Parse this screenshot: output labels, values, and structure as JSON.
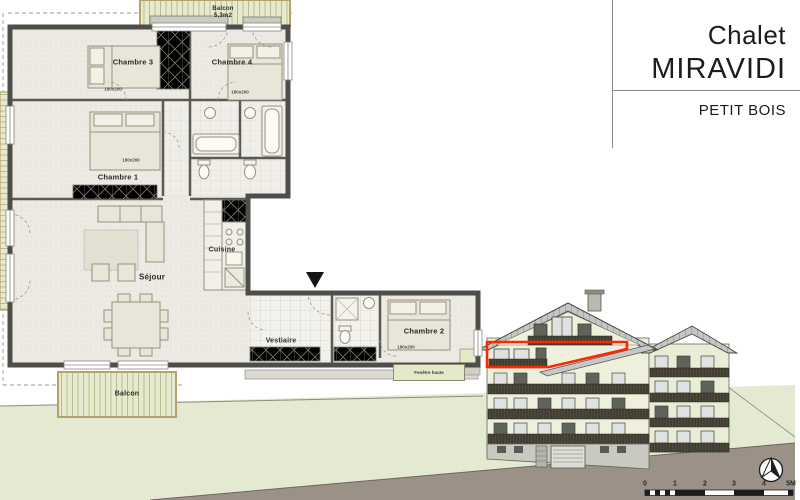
{
  "title_block": {
    "project": "Chalet",
    "name": "MIRAVIDI",
    "unit": "PETIT BOIS"
  },
  "plan": {
    "balcony_top": {
      "label": "Balcon",
      "area": "5,3m2"
    },
    "balcony_bottom": {
      "label": "Balcon"
    },
    "rooms": {
      "chambre1": {
        "label": "Chambre 1",
        "size": "180x200"
      },
      "chambre2": {
        "label": "Chambre 2",
        "size": "180x200"
      },
      "chambre3": {
        "label": "Chambre 3",
        "size": "180x200"
      },
      "chambre4": {
        "label": "Chambre 4",
        "size": "180x200"
      },
      "sejour": {
        "label": "Séjour"
      },
      "cuisine": {
        "label": "Cuisine"
      },
      "vestiaire": {
        "label": "Vestiaire"
      }
    },
    "window_note": "Fenêtre haute"
  },
  "elevation": {
    "highlight_color": "#ff2600"
  },
  "scale_bar": {
    "ticks": [
      "0",
      "1",
      "2",
      "3",
      "4",
      "5M"
    ]
  },
  "colors": {
    "highlight_red": "#ff2600",
    "site_green": "#e4ead1",
    "road_gray": "#9b9187",
    "roof_gray": "#c6c6c6",
    "facade": "#eef0dc",
    "plan_wall": "#4d4d4d",
    "balcony_stripe": "#e3e9c9"
  }
}
